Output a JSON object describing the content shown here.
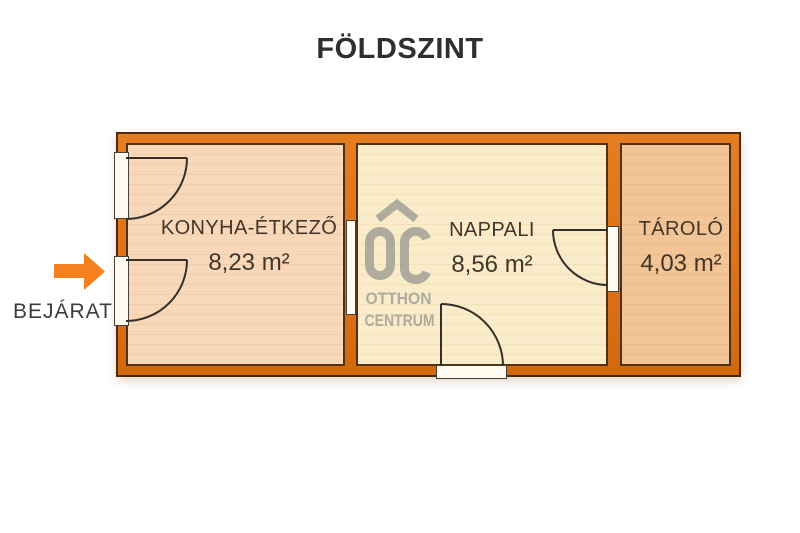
{
  "title": "FÖLDSZINT",
  "entrance": {
    "label": "BEJÁRAT",
    "arrow_color": "#f5801e",
    "arrow_direction": "right"
  },
  "watermark": {
    "name": "OTTHON CENTRUM",
    "logo_letters": "OC",
    "line1": "OTTHON",
    "line2": "CENTRUM",
    "color": "#a3a196"
  },
  "floorplan": {
    "wall_color": "#dd7219",
    "rooms": [
      {
        "name": "KONYHA-ÉTKEZŐ",
        "area": "8,23 m²",
        "floor_color": "#f8d8b9"
      },
      {
        "name": "NAPPALI",
        "area": "8,56 m²",
        "floor_color": "#faecca"
      },
      {
        "name": "TÁROLÓ",
        "area": "4,03 m²",
        "floor_color": "#f3c495"
      }
    ]
  }
}
